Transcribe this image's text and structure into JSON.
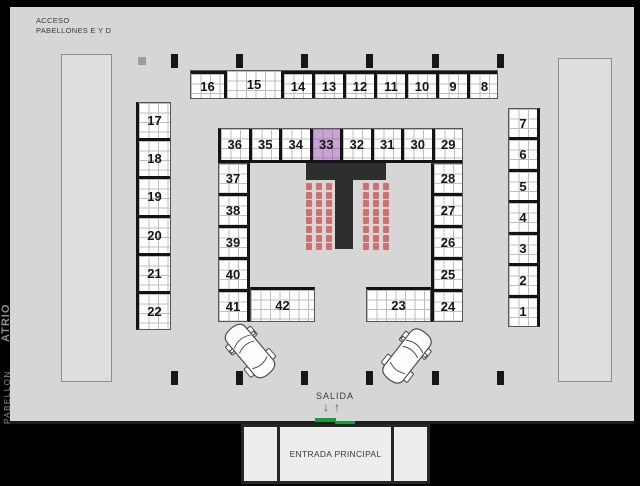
{
  "top_left": {
    "line1": "ACCESO",
    "line2": "PABELLONES E Y D"
  },
  "left_edge": {
    "pavilion_small": "PABELLON",
    "pavilion_large": "ATRIO"
  },
  "exit": {
    "label": "SALIDA"
  },
  "entrance": {
    "label": "ENTRADA PRINCIPAL"
  },
  "booths": {
    "top_row": [
      "16",
      "15",
      "14",
      "13",
      "12",
      "11",
      "10",
      "9",
      "8"
    ],
    "left_column": [
      "17",
      "18",
      "19",
      "20",
      "21",
      "22"
    ],
    "right_column": [
      "7",
      "6",
      "5",
      "4",
      "3",
      "2",
      "1"
    ],
    "inner_top_row": [
      "36",
      "35",
      "34",
      "33",
      "32",
      "31",
      "30",
      "29"
    ],
    "inner_left_column": [
      "37",
      "38",
      "39",
      "40",
      "41"
    ],
    "inner_right_column": [
      "28",
      "27",
      "26",
      "25",
      "24"
    ],
    "inner_bottom_left": "42",
    "inner_bottom_right": "23",
    "highlighted_booth": "33"
  },
  "stage_seating": {
    "blocks": 2,
    "rows_per_block": 8,
    "cols_per_block": 3
  },
  "structures": {
    "stage": "T-shaped runway stage",
    "pillars_top": 6,
    "pillars_bottom": 6,
    "cars": 2
  },
  "colors": {
    "background": "#000000",
    "floor": "#d6d6d6",
    "booth_fill": "#ffffff",
    "grid_line": "#bdbdbd",
    "divider": "#141414",
    "highlight_fill": "#c9a3d2",
    "highlight_grid": "#a982b5",
    "stage": "#2e2e2e",
    "chair": "#cf6f6f",
    "door_green": "#169c3e",
    "side_text": "#8f8f8f"
  }
}
